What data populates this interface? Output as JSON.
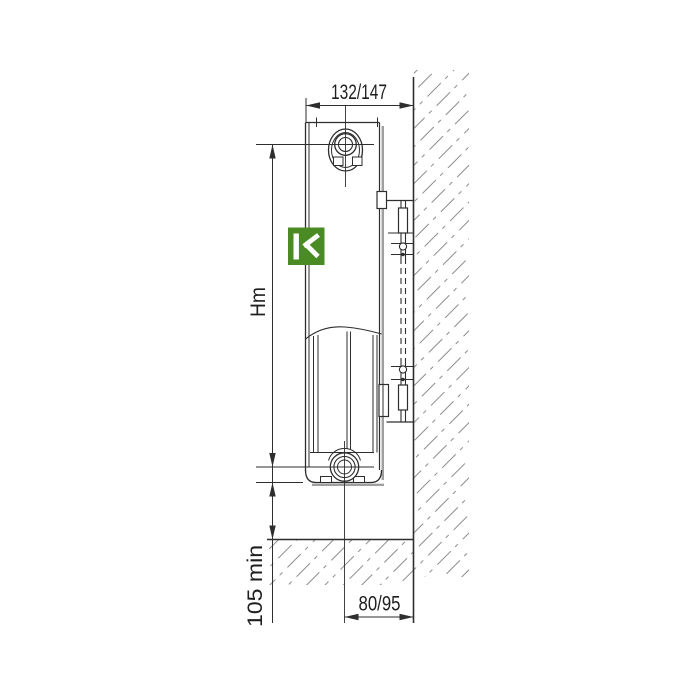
{
  "diagram": {
    "description": "Panel radiator side-view wall mounting drawing",
    "labels": {
      "depth": "132/147",
      "height": "Hm",
      "floor_clearance": "105 min",
      "pipe_wall_offset": "80/95"
    },
    "icons": {
      "logo": "brand-k-logo"
    },
    "colors": {
      "background": "#ffffff",
      "line": "#2e2e2e",
      "hatch": "#8c8c8c",
      "logo_green": "#4b8b24",
      "logo_glyph": "#ffffff"
    }
  }
}
